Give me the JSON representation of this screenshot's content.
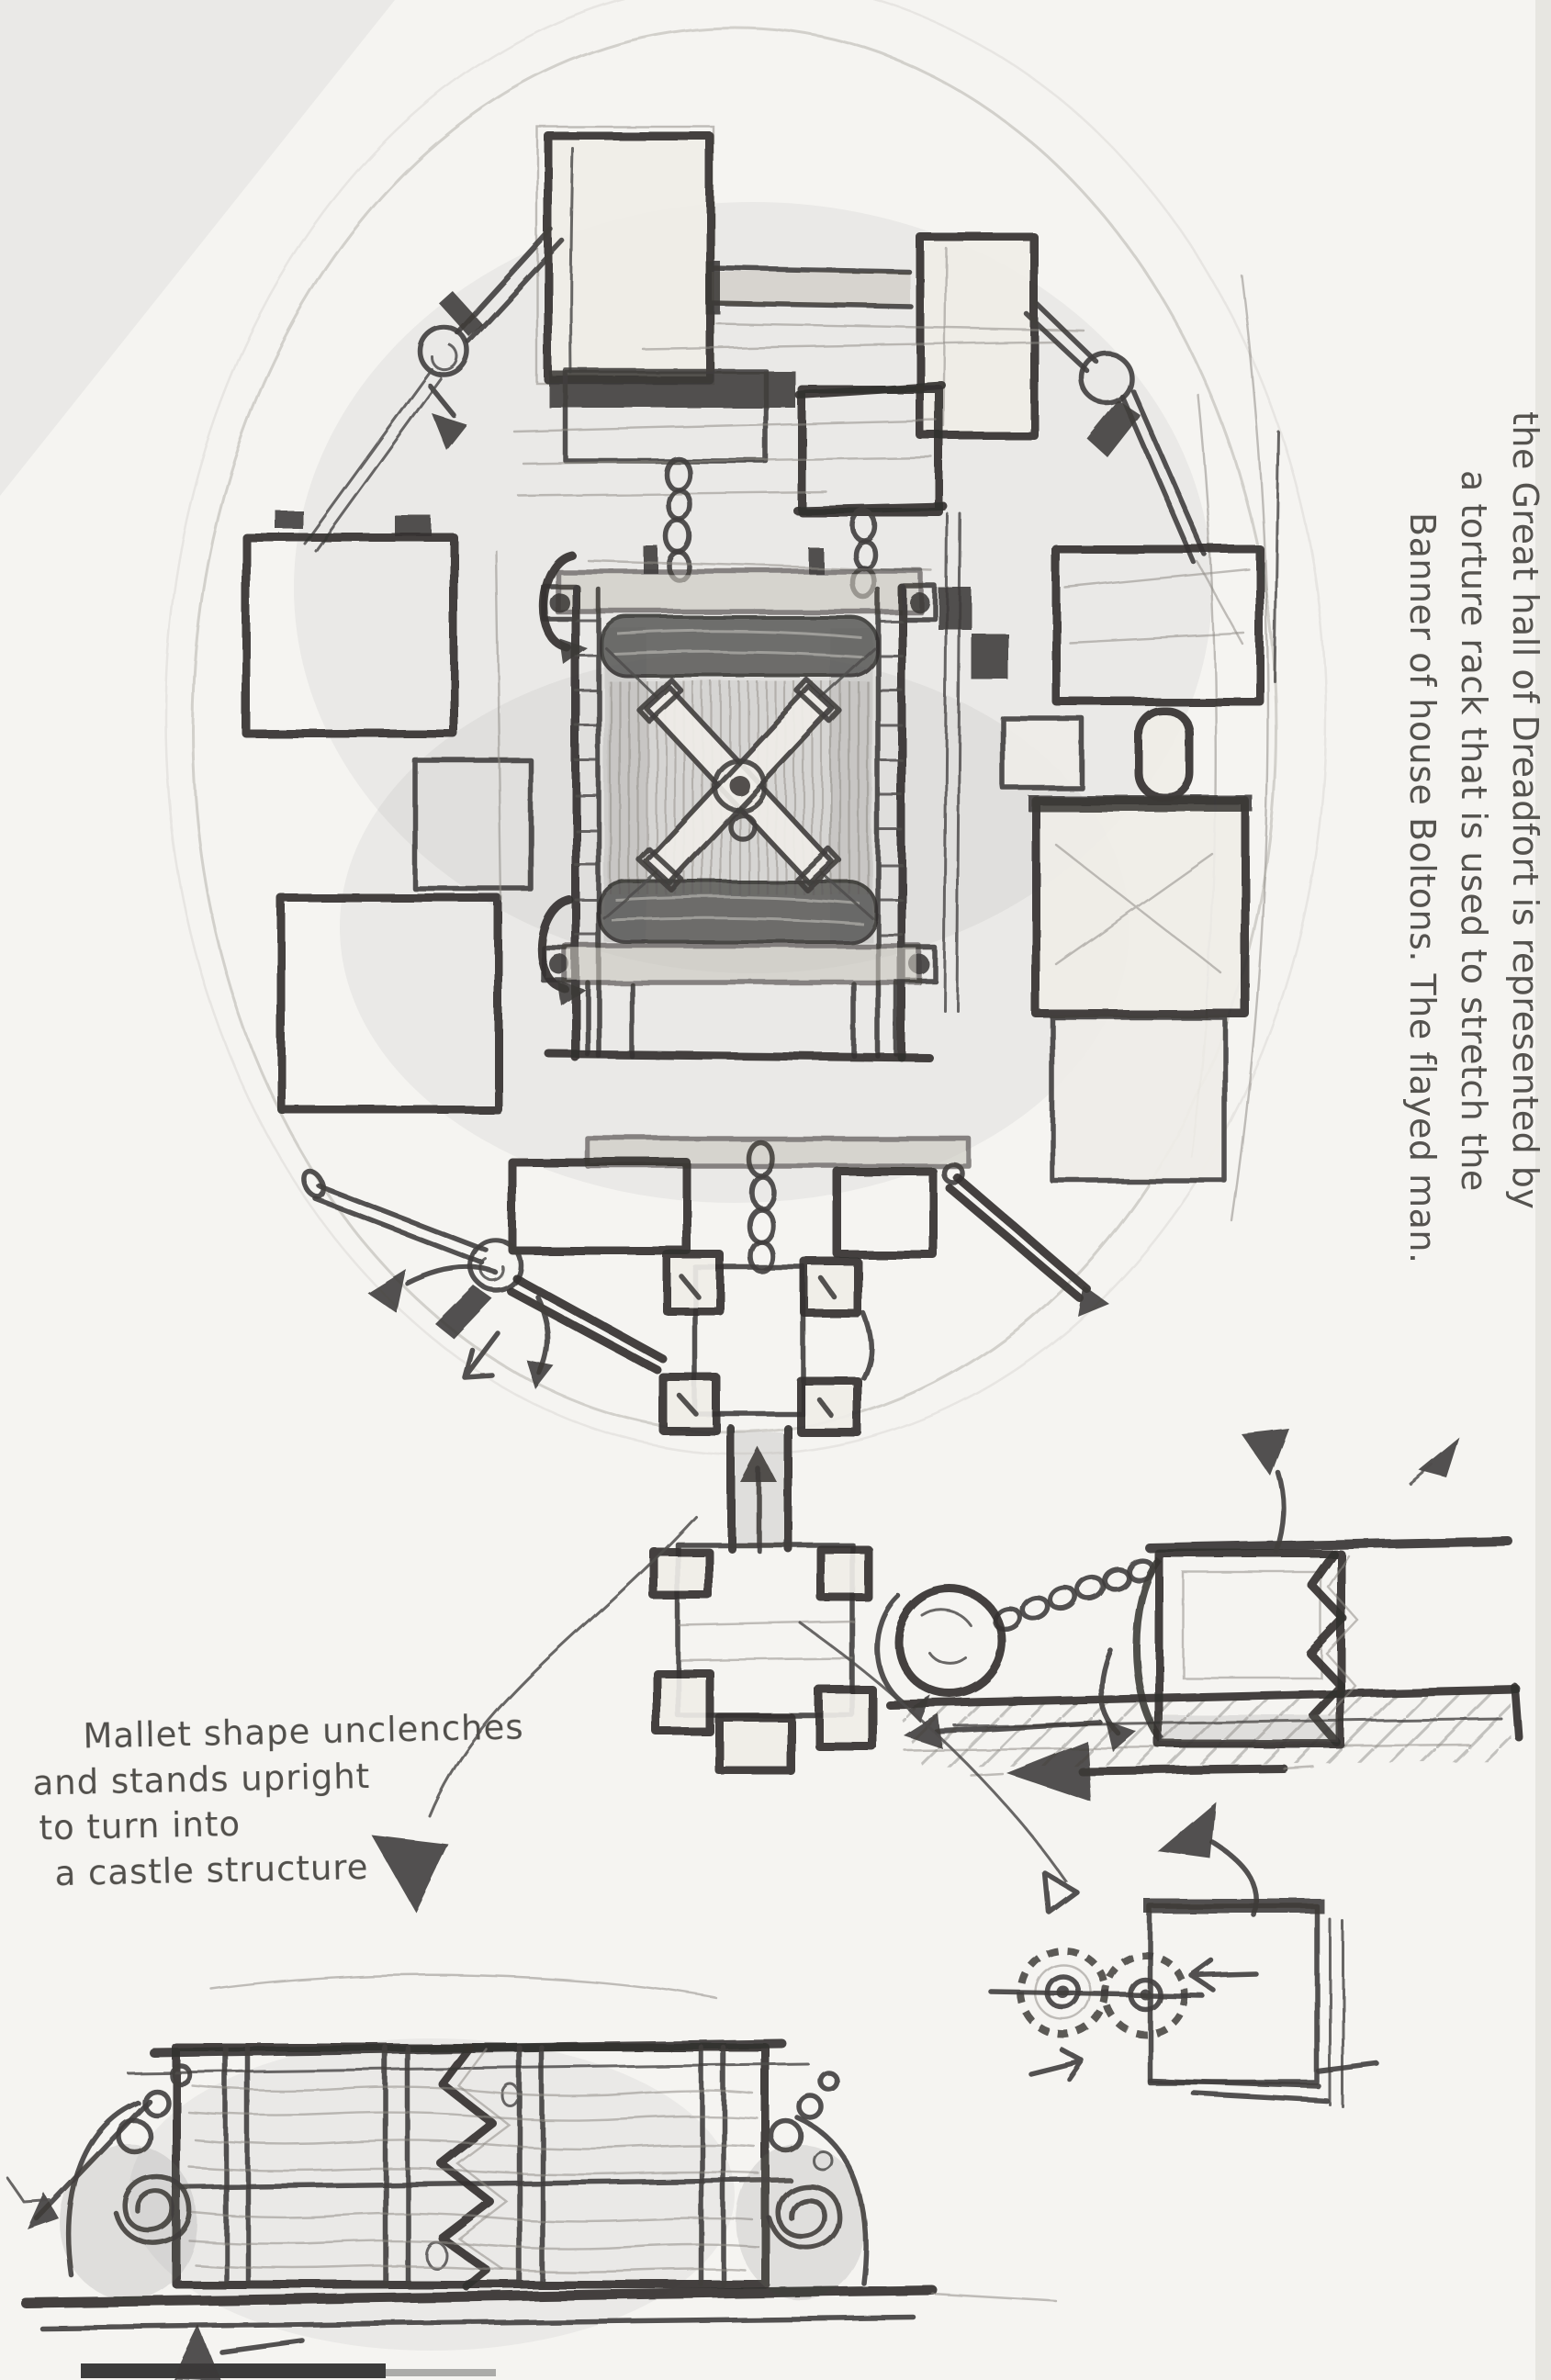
{
  "page": {
    "paper_color": "#f5f4f1",
    "pencil_color": "#4a4a4a",
    "scan_bar_color": "#222222"
  },
  "notes": {
    "right_note": {
      "lines": [
        "the Great hall of Dreadfort is represented by",
        "a torture rack that is used to stretch the",
        "Banner of house Boltons. The flayed man."
      ]
    },
    "left_note": {
      "lines": [
        "Mallet shape unclenches",
        "and stands upright",
        "to turn into",
        "a castle structure"
      ]
    }
  }
}
